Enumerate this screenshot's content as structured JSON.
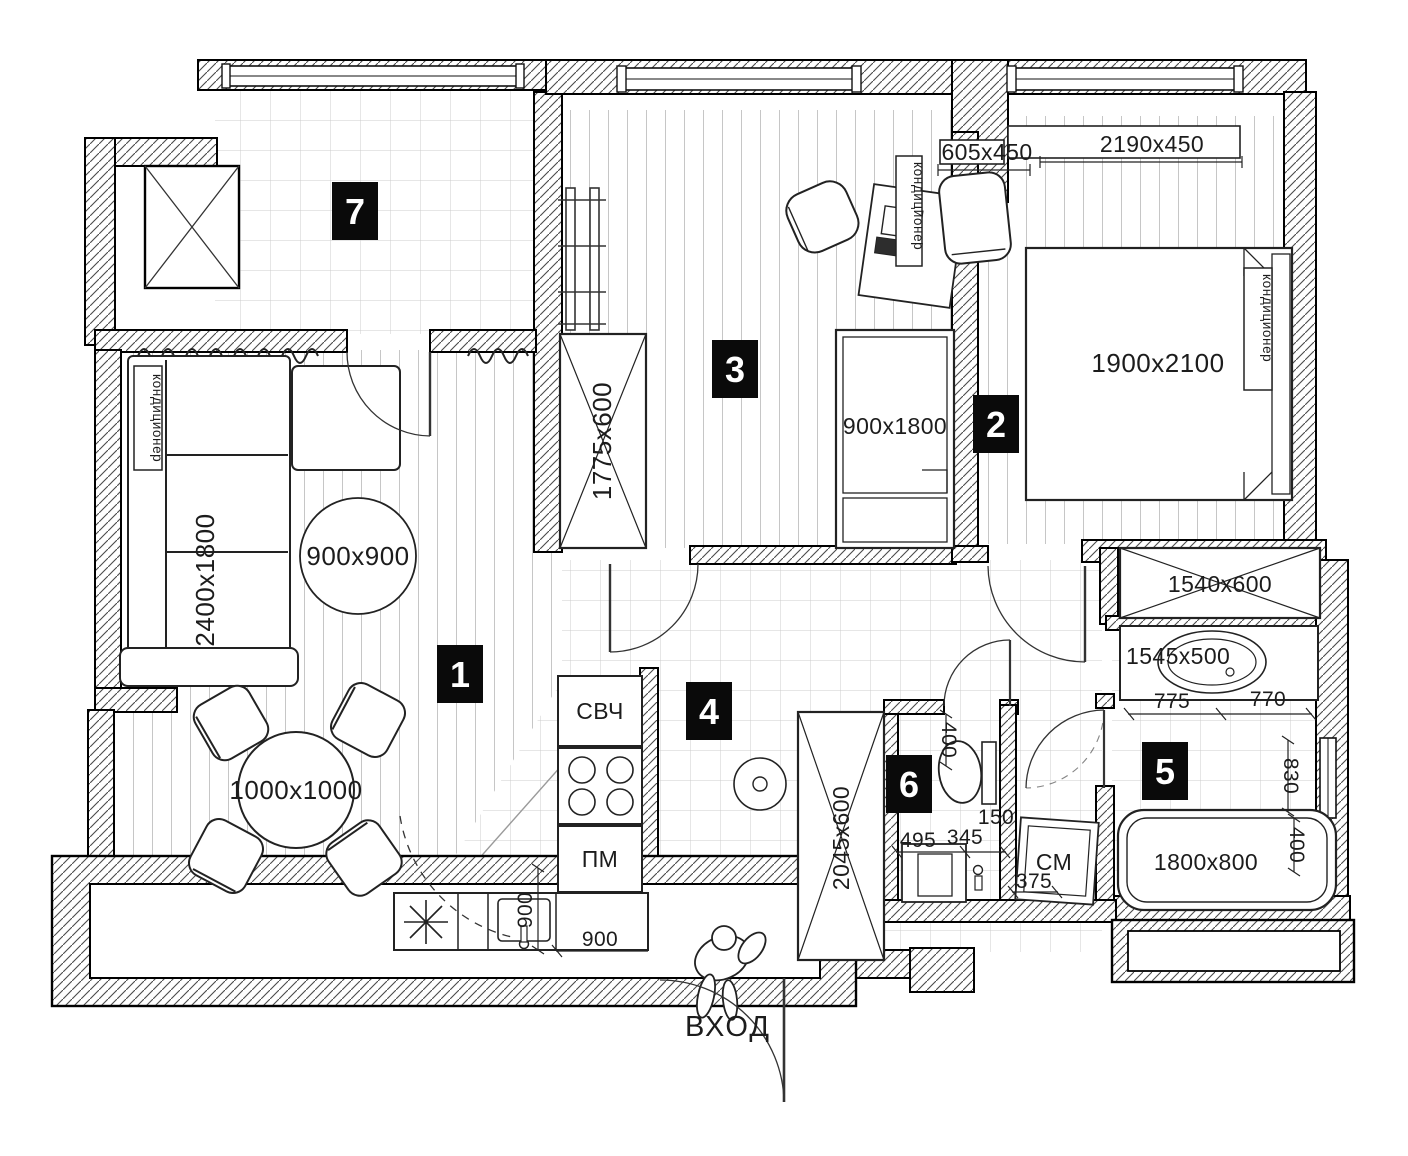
{
  "plan": {
    "entrance_label": "ВХОД",
    "badges": [
      "1",
      "2",
      "3",
      "4",
      "5",
      "6",
      "7"
    ],
    "furniture": {
      "sofa": "2400x1800",
      "rug": "900x900",
      "dining_table": "1000x1000",
      "wardrobe_room3": "1775x600",
      "bed_room3": "900x1800",
      "bed_room2": "1900x2100",
      "shelf_small": "605x450",
      "shelf_long": "2190x450",
      "closet_hall": "1540x600",
      "vanity": "1545x500",
      "bathtub": "1800x800",
      "wardrobe_hall": "2045x600",
      "microwave": "СВЧ",
      "dishwasher": "ПМ",
      "washing_machine": "СМ",
      "air_conditioner": "кондиционер"
    },
    "dims": {
      "w775": "775",
      "w770": "770",
      "h830": "830",
      "h400_bath": "400",
      "h400_wc": "400",
      "w495": "495",
      "w345": "345",
      "w150": "150",
      "w375": "375",
      "h900_kitchen": "900",
      "w900_kitchen": "900"
    },
    "colors": {
      "ink": "#1c1c1c",
      "badge_bg": "#0a0a0a",
      "floor_line": "#c6c6c6"
    }
  }
}
